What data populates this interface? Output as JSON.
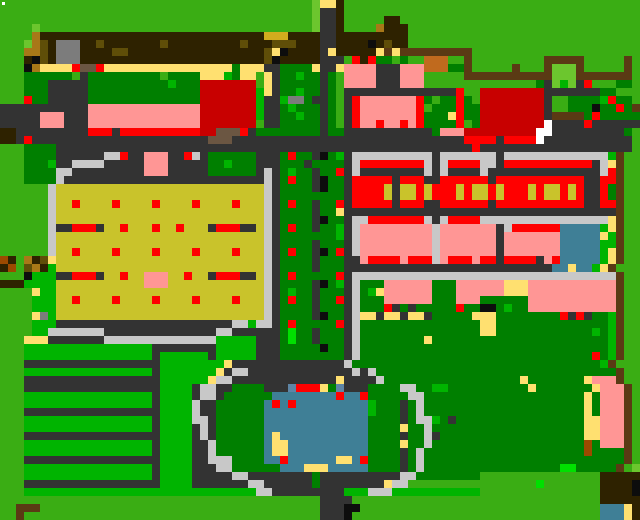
{
  "map": {
    "width": 640,
    "height": 520,
    "cell_size": 8,
    "cols": 80,
    "rows_count": 65,
    "palette": {
      "g": "#3AAD14",
      "e": "#00B400",
      "m": "#00E000",
      "G": "#007F00",
      "L": "#6CC62E",
      "Y": "#C9C32B",
      "k": "#FFE070",
      "P": "#FF9695",
      "R": "#FF0000",
      "D": "#C80000",
      "B": "#3F7F96",
      "S": "#5E85A5",
      "c": "#C8C8C8",
      "y": "#7C7C7C",
      "r": "#333333",
      "K": "#0D0D0D",
      "b": "#2E2200",
      "n": "#5A3A14",
      "o": "#A87818",
      "v": "#5F4E08",
      "M": "#D2AC1E",
      "u": "#6B5642",
      "q": "#9C4A00",
      "O": "#C06A1E",
      "w": "#FFFFFF"
    },
    "rows": [
      "gggggggggggggggggggggggggggggggggggggggLkkbggggggggggggggggggggggggggggggggggggg",
      "gggggggggggggggggggggggggggggggggggggggLrrbggggggggggggggggggggggggggggggggggggg",
      "gggggggggggggggggggggggggggggggggggggggLrrbgggggbbgggggggggggggggggggggggggggggg",
      "ggggLggggggggggggggggggggggggggggggggggLrrbggggobbbggggggggggggggggggggggggggggg",
      "ggggobbbbbbbbbbbbbbbbbbbbbbbbbbbbMMMbbbbrrbbbbbbbbbggggggggggggggggggggggggggggg",
      "gggLovbyyybbvbbbbbbbvbbbbbbbbbvbbbvvvbbbrrbbbbKbvbbggggggggggggggggggggggggggggg",
      "gggoovbyyybbbbvvbbbbbbbbbbbbbbbbbvkKbbbbrkbbbbbknknnnnnnnnnggggggggggggggggggggg",
      "gggbKvbyyybbbbbbbbbbbbbbbbbbbbbbbvKbbbbbr rrgRbRGGgGggOOOggngggggggggnnnnngggggng",
      "gggKokkkkRuuRkkkkkkkkkkkkkkkkGkkkrrGGGGkrrkPPPPrrrPPPOOOGGngggggngggnLLLngggggng",
      "gggGGGGGGgrGGGGGGGGGgGGGGkkkeGkkgkrGGeGGrGgPPPPrrrPPPgggggnnnnnnnnnnnLLLnnnnnnng",
      "gggGGGrrrrrGGGGGGGGGGeGGGDDDDDDDgkrGGGGGrGgPPPPrrrPPPggggggggggggggGrLeLrRgggGGg",
      "gggGGGrrrrrGGGGGGGGGGGGGGDDDDDDDekrGGeGGrGgrrrrrrrrrrrrrrRggDDDDDDDDrrrrrrrGGggg",
      "gggRGGrrrrrGGGGGGGGGGGGGGDDDDDDDerreyyGrrGgrRPPPPPPPRGgGGRGgDDDDDDDDrggGGGGeRGGg",
      "rrrrrrrrrrrPPPPPPPPPPPPPPDDDDDDDerrGeGGGrGgrRPPPPPPPRgGGGRGGDDDDDDDDrggGGGKGGRGn",
      "rrrrrPPPrrrPPPPPPPPPPPPPPDDDDDDDerrGGeGGrGgrRPPPPPPPRGGGkRGGDDDDDDDDrnnnnGRGGGGG",
      "rrrrrPPPrrrPPPPPPPPPPPPPPDDDDDDDgrrGGGGGrGgrRPPRPPRPRGGGGRgGDDDDDDDDwrrrrRrrrrrr",
      "bbrrrrrrrrrRRRrRRRRRRRRRRDDuuuRrGGGGGGGGrGGrrrrrrrrrrrGPPPDDDDDDDDDwwrrrrrrrrrGg",
      "bbrRrrrrrrrrrrrrrrrrrrrrrruuurrrrrrrrrrrrrrrrrrrrrrrrrrrrrRRRRrRRRRwrrrrrrrrrrr",
      "gggGGGGrrrrrrrrrrrrrrrrrrrrrrrrrrrrrrrrrrrrrrrrrrrrrrrrrrrrRrrrrrrrrrrrrrrrrrrr",
      "gggGGGGrrrrrrccRrrPPPrrRcrGGGGGGrrrGRGGrKGerccccccccccrcccccccrcccccccccccccengg",
      "gggGGGerrccccrrrrrPPPrrrrrGGeGGGrrrGGGrGGGGrcRRRRRRRRcrcRRRRccrRRRRRRRRRRRrckngg",
      "gggGGGGccrrrrrrrrrPPPrrrrrGGGGGGrcrGeGGrGGRrcrrrrrrrrcrcrrrrcrrrrrrrrrrrrrrcRngg",
      "gggGGGGcrrrrrrrrrrrrrrrrrrrrrrrrrcrGRGGrKGGrRRRRRrRRRrrRRRRRRrRRRRRRRRRRRrrRRngg",
      "ggggggcYYYYYYYYYYYYYYYYYYYYYYYYYYcrGGGGrKGGrRRRRYrYYRYRRRYRYYRYRRRYRYYRYRrrRGngg",
      "ggggggcYYYYYYYYYYYYYYYYYYYYYYYYYYcrGGGGGGGGrRRRRYrYYRYRRRYRYYRYRRRYRYYRYRrrRGngg",
      "ggggggcYYRYYYYRYYYYRYYYYRYYYYRYYYcrGRGGrGGRrRRRRRrRRRrrRRRRRRrRRRRRRRRRRRrrRRngg",
      "ggggggcYYYYYYYYYYYYYYYYYYYYYYYYYYcrGGGGrGGkrrrrrrrrrrrrrrrrrrrrrrrrrrrrrrrrrrngg",
      "ggggggcYYYYYYYYYYYYYYYYYYYYYYYYYYcrGGGGrKGGrccRRRRRRRcrcRRRRcccccccccccccccckngg",
      "ggggggcrrRRRrYYRYYYRYYRYYYrRRRrrYcrGRGGrGGercPPPPPPPPPcPPPPPPPrcRRRRRRBBBBBekngg",
      "ggggggcYYYYYYYYYYYYYYYYYYYYYYYYYYcrGGGGGGGercPPPPPPPPPcPPPPPPPrPPPPPPPBBBBBkengg",
      "ggggggcYYYYYYYYYYYYYYYYYYYYYYYYYYcrGGGGrGGGrcPPPPPPPPPcPPPPPPPrPPPPPPPBBBBBeengg",
      "ggggggcYYRYYYYRYYYYRYYYYRYYYYRYYYcrGRGGrKGRrcPPPPPPPPPcPPPPPPPrPPPPPPPBBBBBekngg",
      "qbgobvkYYYYYYYYYYYYYYYYYYYYYYYYYYcrGGGGrGGGrrPRRRRPRRRcPRRRPRRrRRRRrPRBBBBBekngg",
      "bqgvobeYYYYYYYYYYYYYYYYYYYYYYYYYYcrGGGGrGGGrrrrrrrrrrrrrrrrrrrrrrrrrrBBkBBekngg",
      "gggKeeerrRRRrYYRYYPPPYYRYYrRRRrrYcrGRGGGGGRrcccccccccccccccccccccccccccccccccngg",
      "bbbeeeeYYYYYYYYYYYPPPYYYYYYYYYYYYcrGGGGrKGercGGGPPPPPPGGGPPPPPPkkkPPPPPPPPPPPngg",
      "ggggkeeYYYYYYYYYYYYYYYYYYYYYYYYYYcrGeGGrGGGrcGekPPPPPPGGGPPPPPPkkkPPPPPPPPPPPngg",
      "ggggeeeYYRYYYYRYYYYRYYYYRYYYYRYYYcrGRGGrGGRrcGGGPPPPPPGGGPPPGGGGGGPPPPPPPPPPPngg",
      "ggggeeeYYYYYYYYYYYYYYYYYYYYYYYYYYcrGGGGrGGGrcGGGRrGrGGGGGRGGKKGeGGPPPPPPPPPPPngg",
      "ggggkyeYYYYYYYYYYYYYYYYYYYYYYYYYYcrGGGGrKGGrckkrkkrkkrGGGGGkkkGGGGGGGGRrRrGGengg",
      "ggggeeerrrrrrrrrrrrrrrrrrrrrrcceccrGRGGGGGRrcGGGGGGGGGGGGGGGkkGGGGGGGGGGGGGGengg",
      "ggggeecccccccrrrrrrrrrrrrrrccrrrrrrGmGGrGGGrcGGGGGGGGGGGGGGGkkGGGGGGGGGGGGeGengg",
      "gggkkkrrrrrrrcccccccccccccceeeeerrrGmGGrGGGrcGGGGGGGGkGGGGGGGGGGGGGGGGGGGGGGengg",
      "gggeeeeeeeeeeeeeeeerrrrrrrreeeeerrrGGGGGKGGrcGGGGGGGGGGGGGGGGGGGGGGGGGGGGGGGengg",
      "gggeeeeeeeeeeeeeeeereeeeeereeeeerrrGGGGGGGGrcGGGGGGGGGGGGGGGGGGGGGGGGGGGGGRGengg",
      "gggrrrrrrrrrrrrrrrrreeeeeeeekrrrrrrrrrrrrrrcGGGGGGGGGGGGGGGGGGGGGGGGGGGGGGGengg",
      "gggeeeeeeeeeeeeeeeereeeeeeekrccrrrrrrrrrrrrrcrcGGGGGGGGGGGGGGGGGGGGGGGGGGGGGGngg",
      "gggrrrrrrrrrrrrrrrrreeeeeekccrrrrrrrrrrrrrkrrrrcGGGGGGGGGGGGGGGGGkGGGGGGGkPPPngg",
      "gggrrrrrrrrrrrrrrrrreeeerccrrGGGGrrrSRRRkGSrrrGGGGccGGeeGGGGGGGGGGkGGGGGGGkPPPngg",
      "gggeeeeeeeeeeeeeeeereeeerccrGGGGGGBBBBBBBBRBBRGGGGGccGGGGGGGGGGGGGGGGGGGGkGPPPngg",
      "gggeeeeeeeeeeeeeeeereeeecrrGGGGGGBRBRBBBBBBBBBeGGGrGcGGGGGGGGGGGGGGGGGGGGkGPPPngg",
      "gggrrrrrrrrrrrrrrrrreeeecrrGGGGGGBBBBBBBBBBBBBeGGGrGcGGGGGGGGGGGGGGGGGGGGkGPPPngg",
      "gggeeeeeeeeeeeeeeeereeeeccrGGGGGGBBBBBBBBBBBBBGGGGrGcceGrGGGGGGGGGGGGGGGGkkPPPngg",
      "gggeeeeeeeeeeeeeeeereeeercrGGGGGGBBBBBBBBBBBBBGGGGkGGcGGGGGGGGGGGGGGGGGGGkkPPPngg",
      "gggrrrrrrrrrrrrrrrrreeeercrGGGGGGBkBBBBBBBBBBBGGGGrGGcrGGGGGGGGGGGGGGGGGGkkPPPngg",
      "gggeeeeeeeeeeeeeeeereeeerrcGGGGGGBkkBBBBBBBBBBGGGGkGGcGGGGGGGGGGGGGGGGGGGqGPPPngg",
      "gggeeeeeeeeeeeeeeeereeeerrcGGGGGGBkkBBBBBBBBBBGGGGrGcGGGGGGGGGGGGGGGGGGGGqGGGGngg",
      "gggrrrrrrrrrrrrrrrrreeeerrcccGGGGBBRBBBBBBkkBRGGGGrGcGGGGGGGGGGGGGGGGGGGGGGGGGngg",
      "gggeeeeeeeeeeeeeeeereeeerrrccGGGGGGBBBkkkBBBBBGGGGrGcGGGGGGGGGGGGGGGGGmmGGGGGngL",
      "gggeeeeeeeeeeeeeeeereeeerrrrrccrrrrrrrrGrrrrrrrrrrccGGGGGGGGgggggggggggggggbbbbb",
      "gggrrrrrrrrrrrrrrrrreeeerrrrrrrccrrrrrrGrrrrrrrrkccggggggggggggggggmgggggggbbbbK",
      "gggeeeeeeeeeeeeeeeeeeeeeeeeeeeeeccrrrrrrrrreeeccceeeeeeeeeeegggggggggggggggbbbbK",
      "gggggggggggggggggggggggggggggggggggggggg rrrrgggggggggggggggggggggggggggggggbbbbb",
      "ggnnngggggggggggggggggggggggggggggggggggrrrKKggggggggggggggggggggggggggggggBBBkb",
      "ggngggggggggggggggggggggggggggggggggggggrrrKgggggggggggggggggggggggggggggggBBBkb"
    ]
  },
  "overlays": [
    {
      "name": "white-cursor-dot",
      "x": 2,
      "y": 2,
      "w": 3,
      "h": 3,
      "color": "#FFFFFF"
    }
  ],
  "landmarks": [
    {
      "name": "white-cursor-dot-area",
      "x": 0,
      "y": 0,
      "w": 8,
      "h": 8
    },
    {
      "name": "north-hedge-wall",
      "x": 40,
      "y": 32,
      "w": 416,
      "h": 32
    },
    {
      "name": "west-shop-walk",
      "x": 40,
      "y": 64,
      "w": 216,
      "h": 16
    },
    {
      "name": "red-hall",
      "x": 200,
      "y": 80,
      "w": 56,
      "h": 62
    },
    {
      "name": "plaza-shop",
      "x": 344,
      "y": 56,
      "w": 88,
      "h": 74
    },
    {
      "name": "festival-gate",
      "x": 544,
      "y": 56,
      "w": 48,
      "h": 32
    },
    {
      "name": "dark-red-hall",
      "x": 480,
      "y": 88,
      "w": 64,
      "h": 42
    },
    {
      "name": "main-road",
      "x": 0,
      "y": 136,
      "w": 640,
      "h": 24
    },
    {
      "name": "yellow-hall",
      "x": 48,
      "y": 152,
      "w": 248,
      "h": 196
    },
    {
      "name": "boulevard-median",
      "x": 280,
      "y": 152,
      "w": 64,
      "h": 208
    },
    {
      "name": "rowhouses-north",
      "x": 352,
      "y": 152,
      "w": 264,
      "h": 56
    },
    {
      "name": "rowhouses-south",
      "x": 352,
      "y": 208,
      "w": 264,
      "h": 56
    },
    {
      "name": "pool-house",
      "x": 560,
      "y": 224,
      "w": 40,
      "h": 48
    },
    {
      "name": "east-park",
      "x": 352,
      "y": 272,
      "w": 264,
      "h": 120
    },
    {
      "name": "orchard-field",
      "x": 24,
      "y": 344,
      "w": 136,
      "h": 152
    },
    {
      "name": "pond",
      "x": 264,
      "y": 392,
      "w": 120,
      "h": 80
    },
    {
      "name": "pond-plaza-ring",
      "x": 192,
      "y": 360,
      "w": 248,
      "h": 144
    },
    {
      "name": "south-garden",
      "x": 432,
      "y": 390,
      "w": 160,
      "h": 90
    },
    {
      "name": "east-fence",
      "x": 616,
      "y": 152,
      "w": 8,
      "h": 300
    },
    {
      "name": "south-brown-lodge",
      "x": 600,
      "y": 472,
      "w": 40,
      "h": 28
    },
    {
      "name": "south-pool",
      "x": 600,
      "y": 503,
      "w": 32,
      "h": 17
    }
  ]
}
